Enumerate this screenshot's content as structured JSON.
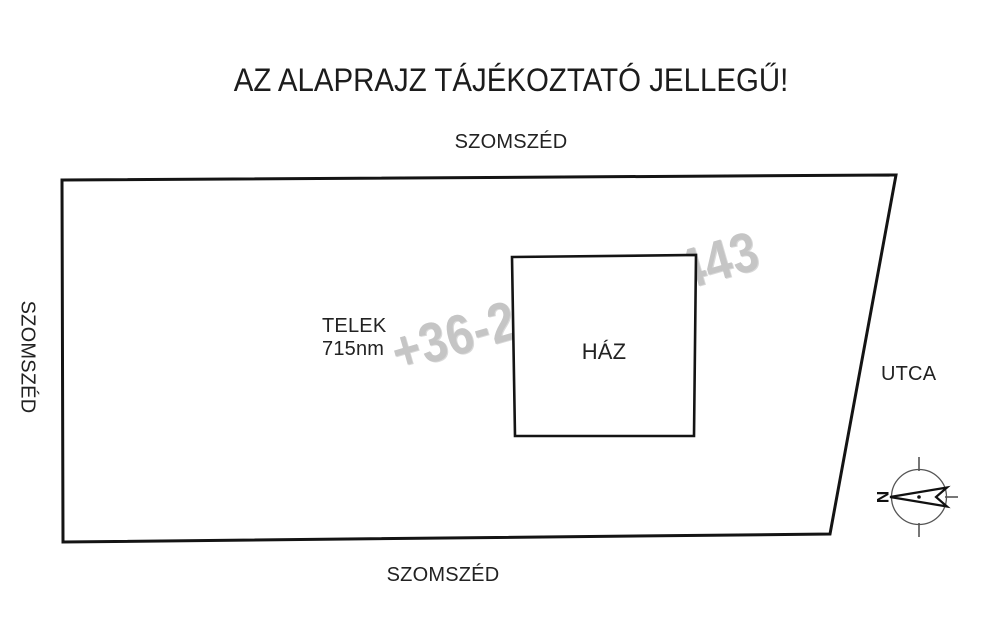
{
  "page": {
    "title": "AZ ALAPRAJZ TÁJÉKOZTATÓ JELLEGŰ!"
  },
  "plan": {
    "neighbor_top": "SZOMSZÉD",
    "neighbor_left": "SZOMSZÉD",
    "neighbor_bottom": "SZOMSZÉD",
    "street": "UTCA",
    "plot_name": "TELEK",
    "plot_size": "715nm",
    "house": "HÁZ"
  },
  "watermark": {
    "phone": "+36-20-329-3443",
    "color": "#c5c5c5"
  },
  "compass": {
    "north_letter": "N"
  },
  "colors": {
    "outline": "#141414",
    "text": "#222222",
    "background": "#ffffff",
    "compass_ring": "#555555"
  }
}
